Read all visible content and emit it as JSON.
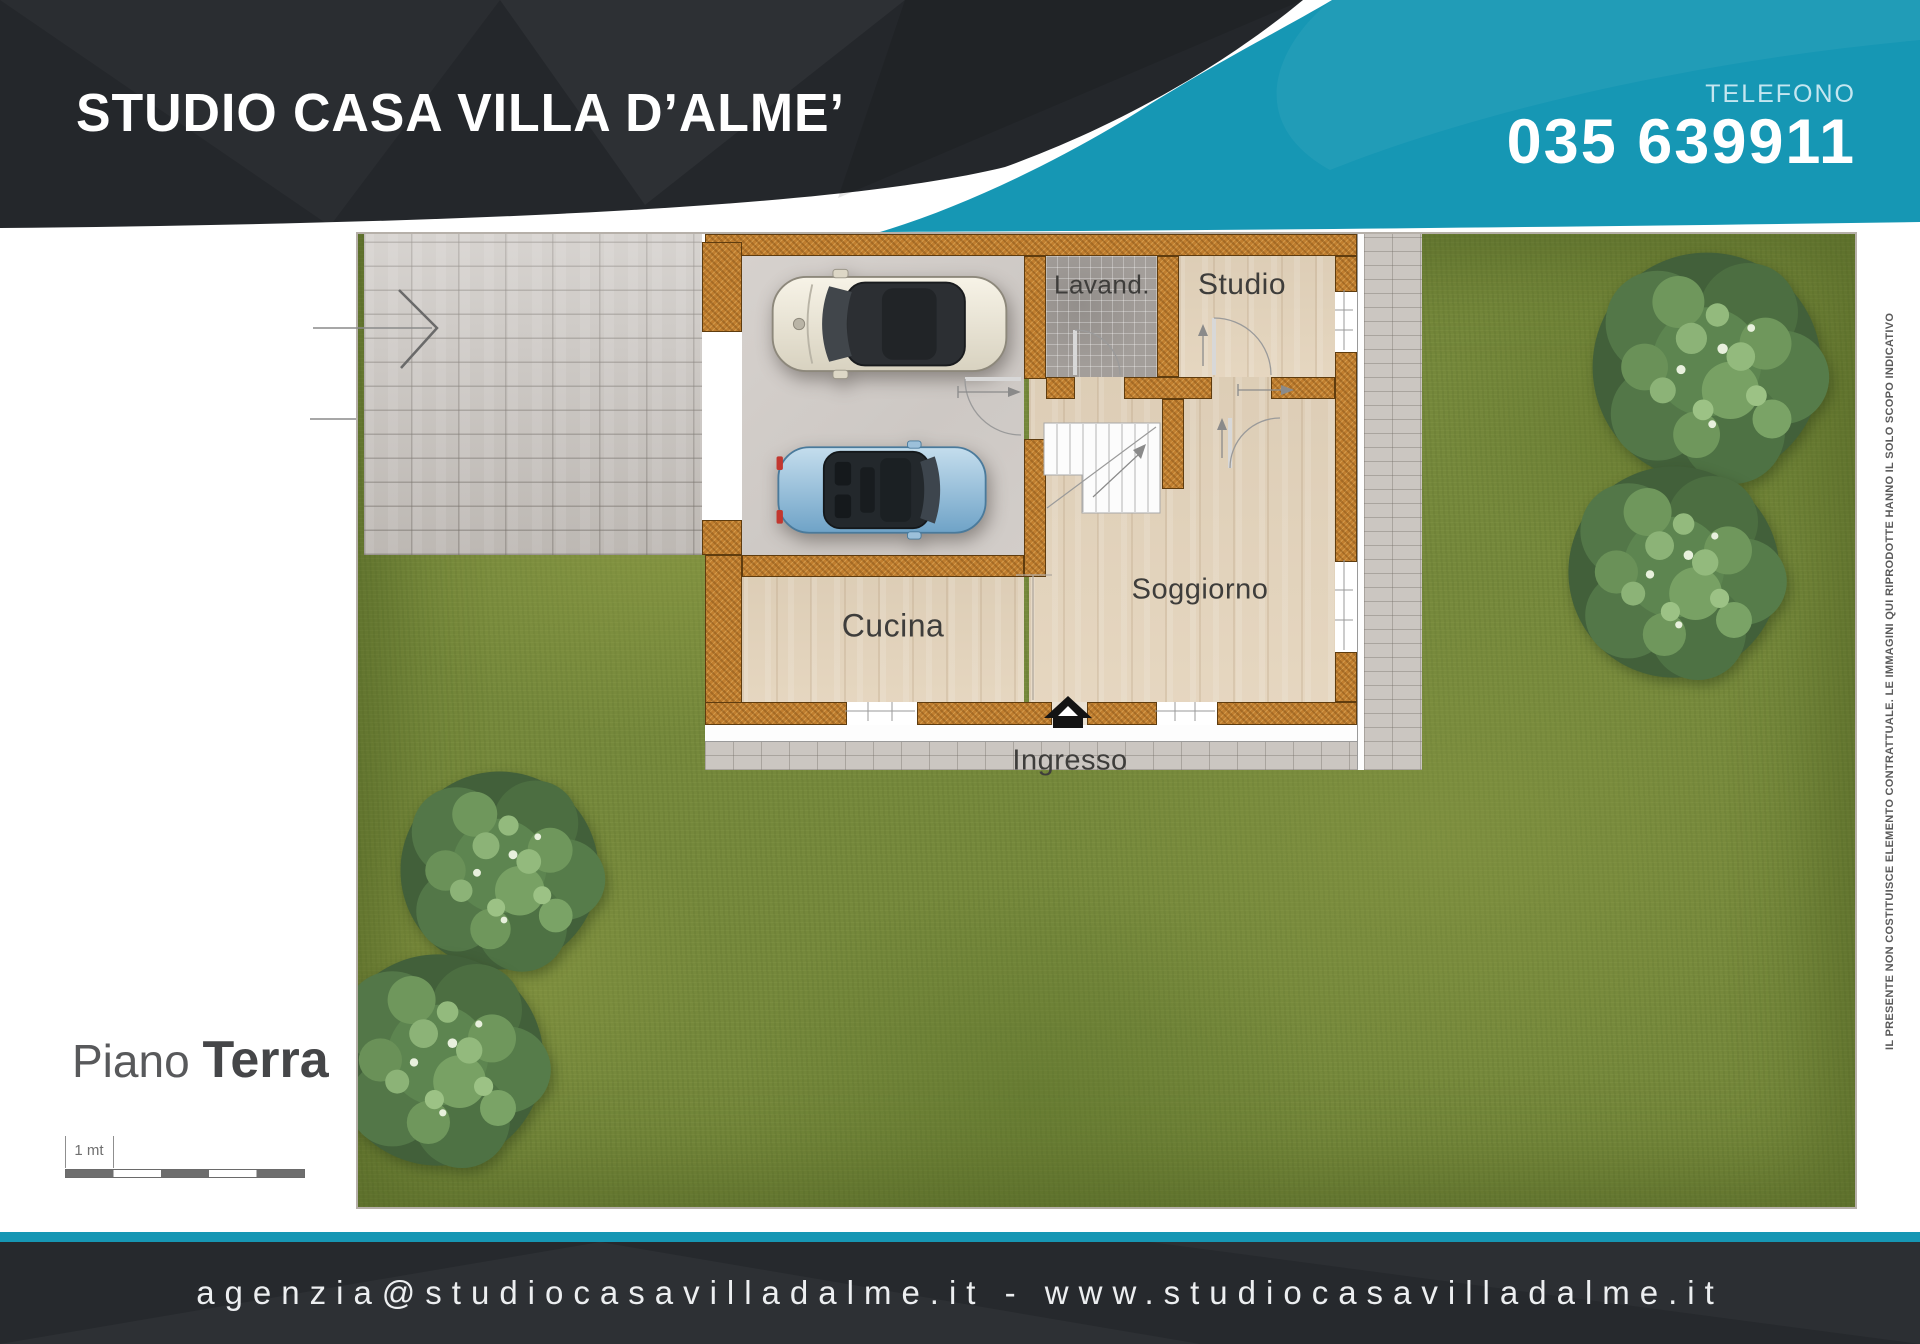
{
  "header": {
    "agency_name": "STUDIO CASA VILLA D’ALME’",
    "phone_label": "TELEFONO",
    "phone_number": "035 639911"
  },
  "plan": {
    "rooms": [
      {
        "id": "lavanderia",
        "label": "Lavand."
      },
      {
        "id": "studio",
        "label": "Studio"
      },
      {
        "id": "soggiorno",
        "label": "Soggiorno"
      },
      {
        "id": "cucina",
        "label": "Cucina"
      }
    ],
    "entrance_label": "Ingresso"
  },
  "floor_title": {
    "prefix": "Piano",
    "name": "Terra"
  },
  "scale_bar": {
    "label": "1 mt"
  },
  "footer": {
    "contact_line": "agenzia@studiocasavilladalme.it - www.studiocasavilladalme.it"
  },
  "side_note": "IL PRESENTE NON COSTITUISCE ELEMENTO CONTRATTUALE. LE IMMAGINI QUI RIPRODOTTE HANNO IL SOLO SCOPO INDICATIVO",
  "colors": {
    "teal": "#1697b4",
    "header_dark": "#24272b",
    "wall_brown": "#c07e2f",
    "grass_green": "#75883b"
  }
}
